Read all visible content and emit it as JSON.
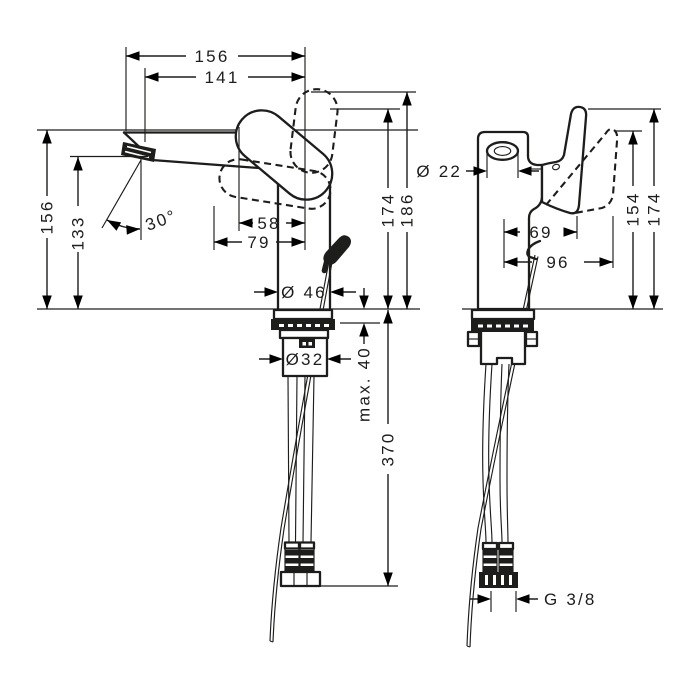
{
  "drawing": {
    "kind": "technical dimension drawing",
    "subject": "single-lever basin mixer faucet",
    "views": {
      "left": "side view",
      "right": "front view"
    },
    "line_color": "#1d1d1b",
    "background": "#ffffff"
  },
  "dims": {
    "side": {
      "reach_total": "156",
      "reach_aerator": "141",
      "height_deck": "156",
      "height_outlet": "133",
      "outlet_angle": "30°",
      "center_offset_inner": "58",
      "center_offset_outer": "79",
      "base_diameter": "Ø 46",
      "height_handle": "174",
      "height_handle_raised": "186",
      "shank_diameter": "Ø32",
      "max_deck_thickness": "max. 40",
      "hose_length": "370"
    },
    "front": {
      "aerator_diameter": "Ø 22",
      "center_to_handle": "69",
      "center_to_handle_tilted": "96",
      "height_handle_tilted": "154",
      "height_handle": "174",
      "connection_thread": "G 3/8"
    }
  }
}
